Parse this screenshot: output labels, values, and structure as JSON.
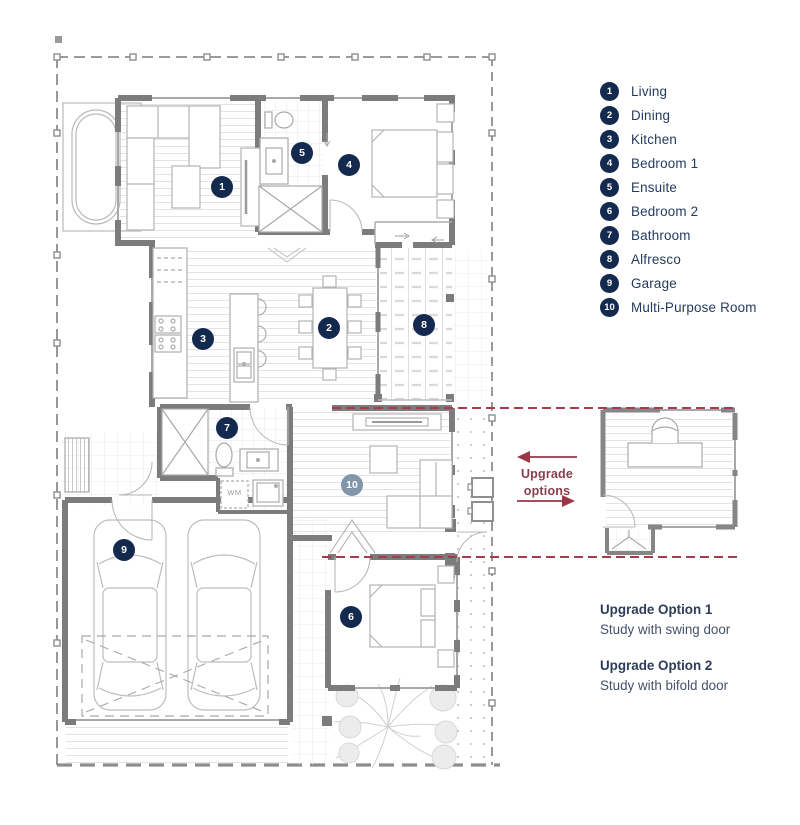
{
  "legend": {
    "items": [
      {
        "number": "1",
        "label": "Living"
      },
      {
        "number": "2",
        "label": "Dining"
      },
      {
        "number": "3",
        "label": "Kitchen"
      },
      {
        "number": "4",
        "label": "Bedroom 1"
      },
      {
        "number": "5",
        "label": "Ensuite"
      },
      {
        "number": "6",
        "label": "Bedroom 2"
      },
      {
        "number": "7",
        "label": "Bathroom"
      },
      {
        "number": "8",
        "label": "Alfresco"
      },
      {
        "number": "9",
        "label": "Garage"
      },
      {
        "number": "10",
        "label": "Multi-Purpose Room"
      }
    ]
  },
  "plan": {
    "markers": [
      {
        "n": "1",
        "room": "living"
      },
      {
        "n": "2",
        "room": "dining"
      },
      {
        "n": "3",
        "room": "kitchen"
      },
      {
        "n": "4",
        "room": "bedroom-1"
      },
      {
        "n": "5",
        "room": "ensuite"
      },
      {
        "n": "6",
        "room": "bedroom-2"
      },
      {
        "n": "7",
        "room": "bathroom"
      },
      {
        "n": "8",
        "room": "alfresco"
      },
      {
        "n": "9",
        "room": "garage"
      },
      {
        "n": "10",
        "room": "multi-purpose-room"
      }
    ],
    "labels": {
      "washing_machine": "WM"
    },
    "upgrade_callout": {
      "line1": "Upgrade",
      "line2": "options"
    }
  },
  "upgrade_options": {
    "option1_title": "Upgrade Option 1",
    "option1_desc": "Study with swing door",
    "option2_title": "Upgrade Option 2",
    "option2_desc": "Study with bifold door"
  },
  "colors": {
    "badge_navy": "#14294e",
    "badge_muted": "#8296ab",
    "accent_red": "#a03648",
    "wall_gray": "#7c7c7c",
    "text_navy": "#243b5e"
  }
}
